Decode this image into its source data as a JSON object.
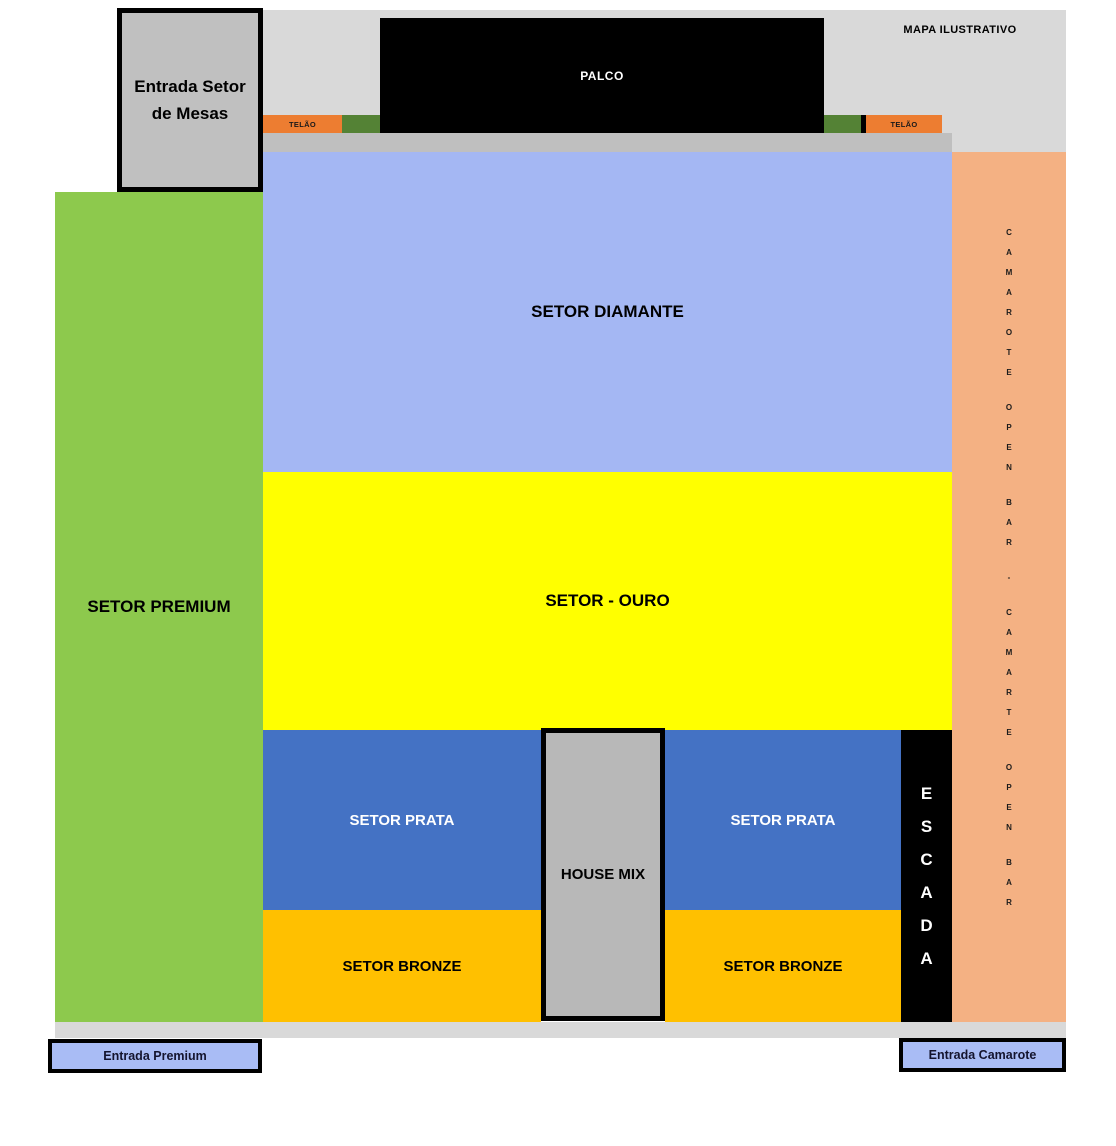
{
  "title_note": "MAPA ILUSTRATIVO",
  "stage": {
    "label": "PALCO"
  },
  "screens": {
    "left": "TELÃO",
    "right": "TELÃO"
  },
  "sectors": {
    "diamante": {
      "label": "SETOR DIAMANTE",
      "color": "#a4b7f3"
    },
    "ouro": {
      "label": "SETOR - OURO",
      "color": "#ffff00"
    },
    "prata_left": {
      "label": "SETOR PRATA",
      "color": "#4472c4"
    },
    "prata_right": {
      "label": "SETOR PRATA",
      "color": "#4472c4"
    },
    "bronze_left": {
      "label": "SETOR BRONZE",
      "color": "#ffc000"
    },
    "bronze_right": {
      "label": "SETOR BRONZE",
      "color": "#ffc000"
    },
    "premium": {
      "label": "SETOR PREMIUM",
      "color": "#8dc94d"
    },
    "house_mix": {
      "label": "HOUSE MIX",
      "color": "#b8b8b8"
    }
  },
  "stairs": {
    "label": "ESCADA",
    "color": "#000000"
  },
  "camarote_column": {
    "words": [
      "CAMAROTE",
      "OPEN",
      "BAR",
      "-",
      "CAMARTE",
      "OPEN",
      "BAR"
    ],
    "color": "#f4b183"
  },
  "entrances": {
    "mesas": "Entrada Setor de Mesas",
    "premium": "Entrada Premium",
    "camarote": "Entrada Camarote"
  },
  "colors": {
    "background_light_gray": "#d9d9d9",
    "strip_gray": "#bfbfbf",
    "stage_black": "#000000",
    "telao_orange": "#ed7d31",
    "side_green": "#548235",
    "entrance_fill": "#a9bcf5"
  }
}
